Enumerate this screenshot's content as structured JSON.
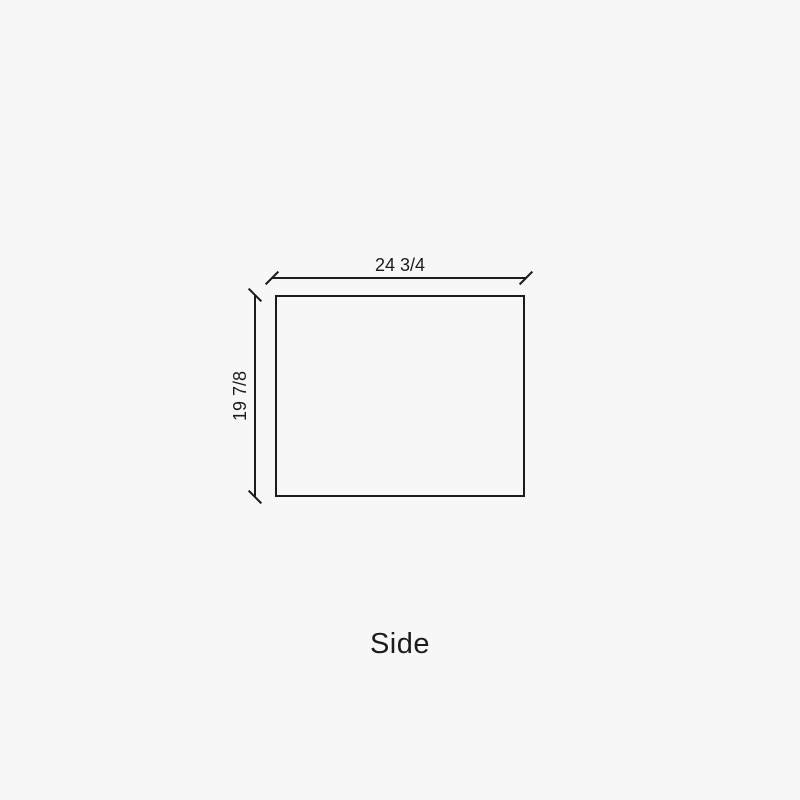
{
  "drawing": {
    "view_label": "Side",
    "width_dimension": "24 3/4",
    "height_dimension": "19 7/8"
  },
  "colors": {
    "background": "#f7f7f7",
    "line": "#1c1c1c",
    "text": "#1c1c1c"
  }
}
